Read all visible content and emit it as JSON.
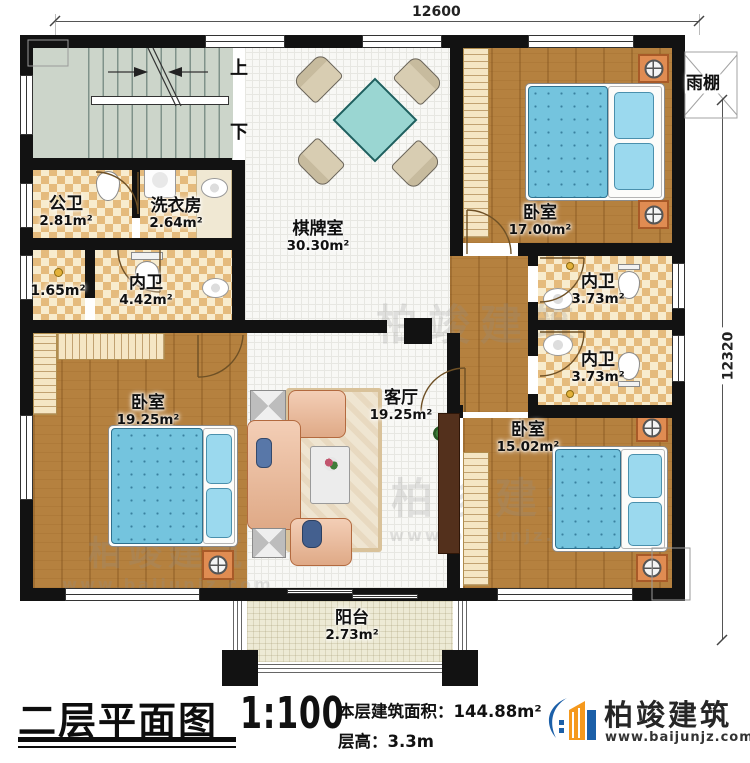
{
  "dimensions": {
    "width_mm": "12600",
    "height_mm": "12320"
  },
  "stair": {
    "up": "上",
    "down": "下"
  },
  "annotations": {
    "canopy": "雨棚"
  },
  "rooms": [
    {
      "id": "public-bath",
      "name": "公卫",
      "area": "2.81m²"
    },
    {
      "id": "laundry",
      "name": "洗衣房",
      "area": "2.64m²"
    },
    {
      "id": "game-room",
      "name": "棋牌室",
      "area": "30.30m²"
    },
    {
      "id": "bedroom-tr",
      "name": "卧室",
      "area": "17.00m²"
    },
    {
      "id": "closet",
      "name": "",
      "area": "1.65m²"
    },
    {
      "id": "ensuite-left",
      "name": "内卫",
      "area": "4.42m²"
    },
    {
      "id": "ensuite-up",
      "name": "内卫",
      "area": "3.73m²"
    },
    {
      "id": "ensuite-down",
      "name": "内卫",
      "area": "3.73m²"
    },
    {
      "id": "bedroom-bl",
      "name": "卧室",
      "area": "19.25m²"
    },
    {
      "id": "living-room",
      "name": "客厅",
      "area": "19.25m²"
    },
    {
      "id": "bedroom-br",
      "name": "卧室",
      "area": "15.02m²"
    },
    {
      "id": "balcony",
      "name": "阳台",
      "area": "2.73m²"
    }
  ],
  "titlebar": {
    "title": "二层平面图",
    "scale": "1:100",
    "area_label": "本层建筑面积：",
    "area_value": "144.88m²",
    "height_label": "层高：",
    "height_value": "3.3m"
  },
  "brand": {
    "name": "柏竣建筑",
    "url": "www.baijunjz.com"
  },
  "watermark": {
    "text": "柏竣建筑",
    "url": "www.baijunjz.com"
  },
  "colors": {
    "wall": "#121212",
    "wood": "#b5813f",
    "checker": "#e5bb7d",
    "bed_teal": "#74c4de",
    "brand_blue": "#1b5fa8",
    "brand_orange": "#f5991d"
  }
}
